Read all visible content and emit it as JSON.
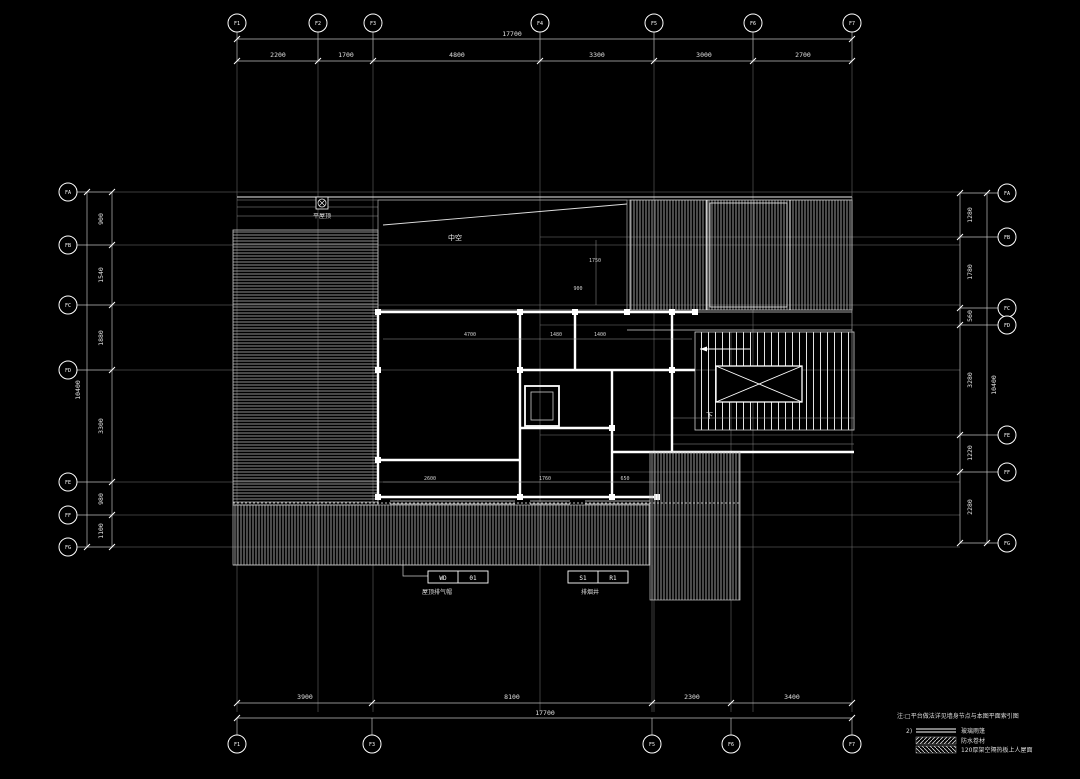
{
  "colors": {
    "background": "#000000",
    "line": "#ffffff",
    "grid_line": "#8a8a8a",
    "dim_text": "#d9d9d9"
  },
  "grid": {
    "top": {
      "labels": [
        "F1",
        "F2",
        "F3",
        "F4",
        "F5",
        "F6",
        "F7"
      ]
    },
    "bottom": {
      "labels": [
        "F1",
        "F3",
        "F5",
        "F6",
        "F7"
      ]
    },
    "left": {
      "labels": [
        "FA",
        "FB",
        "FC",
        "FD",
        "FE",
        "FF",
        "FG"
      ]
    },
    "right": {
      "labels": [
        "FA",
        "FB",
        "FC",
        "FD",
        "FE",
        "FF",
        "FG"
      ]
    }
  },
  "dims": {
    "top_overall": "17700",
    "top_segments": [
      "2200",
      "1700",
      "4800",
      "3300",
      "3000",
      "2700"
    ],
    "bottom_segments": [
      "3900",
      "8100",
      "2300",
      "3400"
    ],
    "bottom_overall": "17700",
    "left_segments": [
      "900",
      "1540",
      "1880",
      "3300",
      "980",
      "1100"
    ],
    "left_overall": "10400",
    "right_segments": [
      "1280",
      "1780",
      "560",
      "3280",
      "1220",
      "2280"
    ],
    "right_overall": "10400"
  },
  "interior_dims": [
    "1750",
    "900",
    "4700",
    "1480",
    "1400",
    "2600",
    "1760",
    "650"
  ],
  "labels": {
    "atrium": "中空",
    "down": "下",
    "flat_roof": "平屋顶"
  },
  "callouts": {
    "wd": {
      "c1": "WD",
      "c2": "01",
      "label": "屋顶排气帽"
    },
    "sr": {
      "c1": "S1",
      "c2": "R1",
      "label": "排烟井"
    }
  },
  "legend": {
    "note": "注:□平台做法详见墙身节点与本图平面索引图",
    "items": [
      {
        "no": "2)",
        "label": "玻璃雨篷"
      },
      {
        "no": "",
        "label": "防水卷材"
      },
      {
        "no": "",
        "label": "120厚架空隔热板上人屋面"
      }
    ]
  }
}
